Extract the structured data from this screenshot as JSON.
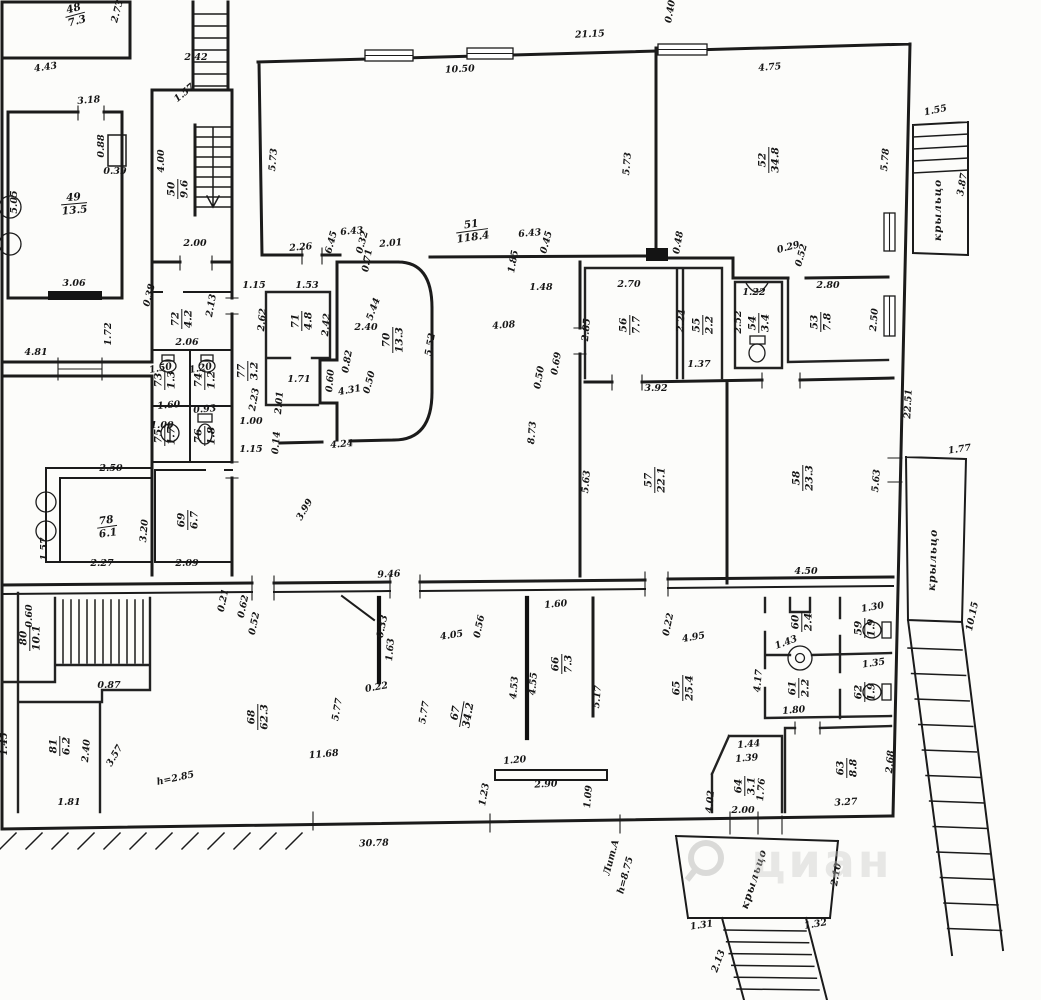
{
  "document": {
    "type": "architectural-floor-plan",
    "language": "ru",
    "watermark": "циан",
    "colors": {
      "paper": "#fcfcfa",
      "ink": "#1b1b1b",
      "watermark": "#c6c6c4"
    }
  },
  "rooms": [
    {
      "num": "48",
      "area": "7.3",
      "x": 75,
      "y": 14,
      "r": -15
    },
    {
      "num": "49",
      "area": "13.5",
      "x": 74,
      "y": 203,
      "r": -5
    },
    {
      "num": "50",
      "area": "9.6",
      "x": 177,
      "y": 189,
      "r": -90
    },
    {
      "num": "51",
      "area": "118.4",
      "x": 472,
      "y": 230,
      "r": -8
    },
    {
      "num": "52",
      "area": "34.8",
      "x": 768,
      "y": 160,
      "r": -90
    },
    {
      "num": "53",
      "area": "7.8",
      "x": 820,
      "y": 322,
      "r": -90
    },
    {
      "num": "54",
      "area": "3.4",
      "x": 758,
      "y": 323,
      "r": -90
    },
    {
      "num": "55",
      "area": "2.2",
      "x": 702,
      "y": 325,
      "r": -90
    },
    {
      "num": "56",
      "area": "7.7",
      "x": 629,
      "y": 325,
      "r": -90
    },
    {
      "num": "57",
      "area": "22.1",
      "x": 654,
      "y": 480,
      "r": -90
    },
    {
      "num": "58",
      "area": "23.3",
      "x": 802,
      "y": 478,
      "r": -90
    },
    {
      "num": "59",
      "area": "1.9",
      "x": 864,
      "y": 628,
      "r": -90
    },
    {
      "num": "60",
      "area": "2.4",
      "x": 801,
      "y": 622,
      "r": -90
    },
    {
      "num": "61",
      "area": "2.2",
      "x": 798,
      "y": 688,
      "r": -90
    },
    {
      "num": "62",
      "area": "1.9",
      "x": 864,
      "y": 692,
      "r": -90
    },
    {
      "num": "63",
      "area": "8.8",
      "x": 846,
      "y": 768,
      "r": -90
    },
    {
      "num": "64",
      "area": "3.1",
      "x": 744,
      "y": 786,
      "r": -90
    },
    {
      "num": "65",
      "area": "25.4",
      "x": 682,
      "y": 688,
      "r": -90
    },
    {
      "num": "66",
      "area": "7.3",
      "x": 561,
      "y": 664,
      "r": -90
    },
    {
      "num": "67",
      "area": "34.2",
      "x": 461,
      "y": 714,
      "r": -80
    },
    {
      "num": "68",
      "area": "62.3",
      "x": 257,
      "y": 717,
      "r": -90
    },
    {
      "num": "69",
      "area": "6.7",
      "x": 187,
      "y": 520,
      "r": -90
    },
    {
      "num": "70",
      "area": "13.3",
      "x": 392,
      "y": 340,
      "r": -90
    },
    {
      "num": "71",
      "area": "4.8",
      "x": 301,
      "y": 321,
      "r": -90
    },
    {
      "num": "72",
      "area": "4.2",
      "x": 181,
      "y": 319,
      "r": -90
    },
    {
      "num": "73",
      "area": "1.3",
      "x": 164,
      "y": 380,
      "r": -90
    },
    {
      "num": "74",
      "area": "1.2",
      "x": 204,
      "y": 380,
      "r": -90
    },
    {
      "num": "75",
      "area": "1.7",
      "x": 164,
      "y": 436,
      "r": -90
    },
    {
      "num": "76",
      "area": "1.8",
      "x": 204,
      "y": 436,
      "r": -90
    },
    {
      "num": "77",
      "area": "3.2",
      "x": 247,
      "y": 371,
      "r": -90
    },
    {
      "num": "78",
      "area": "6.1",
      "x": 107,
      "y": 526,
      "r": -8
    },
    {
      "num": "80",
      "area": "10.1",
      "x": 29,
      "y": 638,
      "r": -90
    },
    {
      "num": "81",
      "area": "6.2",
      "x": 59,
      "y": 746,
      "r": -90
    }
  ],
  "dims": [
    {
      "t": "2.73",
      "x": 120,
      "y": 12,
      "r": -75
    },
    {
      "t": "2.42",
      "x": 196,
      "y": 60,
      "r": 0
    },
    {
      "t": "4.43",
      "x": 46,
      "y": 70,
      "r": -8
    },
    {
      "t": "1.57",
      "x": 186,
      "y": 95,
      "r": -40
    },
    {
      "t": "3.18",
      "x": 89,
      "y": 103,
      "r": -5
    },
    {
      "t": "0.88",
      "x": 104,
      "y": 146,
      "r": -90
    },
    {
      "t": "0.39",
      "x": 115,
      "y": 174,
      "r": 0
    },
    {
      "t": "5.05",
      "x": 17,
      "y": 202,
      "r": -90
    },
    {
      "t": "4.00",
      "x": 164,
      "y": 161,
      "r": -90
    },
    {
      "t": "2.00",
      "x": 195,
      "y": 246,
      "r": 0
    },
    {
      "t": "3.06",
      "x": 74,
      "y": 286,
      "r": 0
    },
    {
      "t": "21.15",
      "x": 590,
      "y": 37,
      "r": -3
    },
    {
      "t": "10.50",
      "x": 460,
      "y": 72,
      "r": -3
    },
    {
      "t": "5.73",
      "x": 276,
      "y": 160,
      "r": -85
    },
    {
      "t": "5.73",
      "x": 630,
      "y": 164,
      "r": -85
    },
    {
      "t": "2.26",
      "x": 301,
      "y": 250,
      "r": -5
    },
    {
      "t": "6.45",
      "x": 334,
      "y": 243,
      "r": -75
    },
    {
      "t": "6.43",
      "x": 352,
      "y": 234,
      "r": -5
    },
    {
      "t": "0.32",
      "x": 365,
      "y": 243,
      "r": -75
    },
    {
      "t": "0.71",
      "x": 370,
      "y": 261,
      "r": -80
    },
    {
      "t": "2.01",
      "x": 391,
      "y": 246,
      "r": -5
    },
    {
      "t": "6.43",
      "x": 530,
      "y": 236,
      "r": -5
    },
    {
      "t": "0.45",
      "x": 549,
      "y": 243,
      "r": -75
    },
    {
      "t": "1.85",
      "x": 516,
      "y": 262,
      "r": -80
    },
    {
      "t": "1.48",
      "x": 541,
      "y": 290,
      "r": 0
    },
    {
      "t": "4.75",
      "x": 770,
      "y": 70,
      "r": -5
    },
    {
      "t": "5.78",
      "x": 888,
      "y": 160,
      "r": -85
    },
    {
      "t": "0.40",
      "x": 673,
      "y": 12,
      "r": -80
    },
    {
      "t": "0.48",
      "x": 681,
      "y": 243,
      "r": -80
    },
    {
      "t": "0.29",
      "x": 789,
      "y": 250,
      "r": -15
    },
    {
      "t": "0.52",
      "x": 804,
      "y": 256,
      "r": -75
    },
    {
      "t": "1.22",
      "x": 754,
      "y": 295,
      "r": 0
    },
    {
      "t": "2.52",
      "x": 741,
      "y": 322,
      "r": -90
    },
    {
      "t": "2.80",
      "x": 828,
      "y": 288,
      "r": 0
    },
    {
      "t": "2.50",
      "x": 877,
      "y": 320,
      "r": -85
    },
    {
      "t": "2.70",
      "x": 629,
      "y": 287,
      "r": 0
    },
    {
      "t": "2.85",
      "x": 589,
      "y": 330,
      "r": -85
    },
    {
      "t": "2.24",
      "x": 684,
      "y": 321,
      "r": -85
    },
    {
      "t": "1.37",
      "x": 699,
      "y": 367,
      "r": 0
    },
    {
      "t": "3.92",
      "x": 656,
      "y": 391,
      "r": 0
    },
    {
      "t": "4.08",
      "x": 504,
      "y": 328,
      "r": -5
    },
    {
      "t": "0.69",
      "x": 559,
      "y": 364,
      "r": -80
    },
    {
      "t": "0.50",
      "x": 542,
      "y": 378,
      "r": -80
    },
    {
      "t": "8.73",
      "x": 535,
      "y": 433,
      "r": -85
    },
    {
      "t": "5.63",
      "x": 589,
      "y": 482,
      "r": -85
    },
    {
      "t": "5.63",
      "x": 879,
      "y": 481,
      "r": -85
    },
    {
      "t": "4.50",
      "x": 806,
      "y": 574,
      "r": 0
    },
    {
      "t": "22.51",
      "x": 911,
      "y": 404,
      "r": -87
    },
    {
      "t": "1.77",
      "x": 960,
      "y": 452,
      "r": -8
    },
    {
      "t": "10.15",
      "x": 975,
      "y": 617,
      "r": -78
    },
    {
      "t": "1.55",
      "x": 936,
      "y": 113,
      "r": -12
    },
    {
      "t": "3.87",
      "x": 965,
      "y": 185,
      "r": -80
    },
    {
      "t": "4.81",
      "x": 36,
      "y": 355,
      "r": 0
    },
    {
      "t": "1.72",
      "x": 111,
      "y": 334,
      "r": -90
    },
    {
      "t": "0.38",
      "x": 152,
      "y": 296,
      "r": -75
    },
    {
      "t": "2.13",
      "x": 214,
      "y": 306,
      "r": -80
    },
    {
      "t": "2.06",
      "x": 187,
      "y": 345,
      "r": 0
    },
    {
      "t": "1.15",
      "x": 254,
      "y": 288,
      "r": 0
    },
    {
      "t": "1.53",
      "x": 307,
      "y": 288,
      "r": 0
    },
    {
      "t": "2.62",
      "x": 265,
      "y": 320,
      "r": -85
    },
    {
      "t": "2.42",
      "x": 329,
      "y": 325,
      "r": -85
    },
    {
      "t": "5.44",
      "x": 376,
      "y": 310,
      "r": -70
    },
    {
      "t": "2.40",
      "x": 366,
      "y": 330,
      "r": 0
    },
    {
      "t": "5.52",
      "x": 433,
      "y": 345,
      "r": -80
    },
    {
      "t": "0.82",
      "x": 350,
      "y": 362,
      "r": -80
    },
    {
      "t": "0.60",
      "x": 333,
      "y": 381,
      "r": -85
    },
    {
      "t": "0.50",
      "x": 372,
      "y": 383,
      "r": -75
    },
    {
      "t": "4.31",
      "x": 350,
      "y": 393,
      "r": -10
    },
    {
      "t": "1.71",
      "x": 299,
      "y": 382,
      "r": 0
    },
    {
      "t": "2.23",
      "x": 257,
      "y": 400,
      "r": -80
    },
    {
      "t": "2.01",
      "x": 282,
      "y": 403,
      "r": -85
    },
    {
      "t": "1.00",
      "x": 251,
      "y": 424,
      "r": 0
    },
    {
      "t": "1.15",
      "x": 251,
      "y": 452,
      "r": 0
    },
    {
      "t": "0.14",
      "x": 279,
      "y": 443,
      "r": -85
    },
    {
      "t": "4.24",
      "x": 342,
      "y": 447,
      "r": -5
    },
    {
      "t": "3.99",
      "x": 307,
      "y": 511,
      "r": -60
    },
    {
      "t": "9.46",
      "x": 389,
      "y": 577,
      "r": -3
    },
    {
      "t": "1.50",
      "x": 161,
      "y": 371,
      "r": -10
    },
    {
      "t": "1.20",
      "x": 201,
      "y": 371,
      "r": -10
    },
    {
      "t": "1.60",
      "x": 169,
      "y": 408,
      "r": -5
    },
    {
      "t": "0.93",
      "x": 205,
      "y": 412,
      "r": -5
    },
    {
      "t": "1.00",
      "x": 162,
      "y": 428,
      "r": 0
    },
    {
      "t": "2.50",
      "x": 111,
      "y": 471,
      "r": 0
    },
    {
      "t": "1.57",
      "x": 47,
      "y": 549,
      "r": -90
    },
    {
      "t": "2.27",
      "x": 102,
      "y": 566,
      "r": 0
    },
    {
      "t": "3.20",
      "x": 147,
      "y": 531,
      "r": -85
    },
    {
      "t": "2.09",
      "x": 187,
      "y": 566,
      "r": 0
    },
    {
      "t": "0.21",
      "x": 226,
      "y": 601,
      "r": -78
    },
    {
      "t": "0.62",
      "x": 246,
      "y": 607,
      "r": -78
    },
    {
      "t": "0.52",
      "x": 257,
      "y": 624,
      "r": -78
    },
    {
      "t": "0.60",
      "x": 32,
      "y": 616,
      "r": -90
    },
    {
      "t": "0.87",
      "x": 109,
      "y": 688,
      "r": 0
    },
    {
      "t": "2.40",
      "x": 89,
      "y": 751,
      "r": -85
    },
    {
      "t": "3.57",
      "x": 117,
      "y": 757,
      "r": -60
    },
    {
      "t": "1.81",
      "x": 69,
      "y": 805,
      "r": 0
    },
    {
      "t": "1.45",
      "x": 7,
      "y": 744,
      "r": -90
    },
    {
      "t": "11.68",
      "x": 324,
      "y": 757,
      "r": -5
    },
    {
      "t": "5.77",
      "x": 340,
      "y": 710,
      "r": -80
    },
    {
      "t": "5.77",
      "x": 427,
      "y": 713,
      "r": -80
    },
    {
      "t": "0.22",
      "x": 377,
      "y": 690,
      "r": -10
    },
    {
      "t": "0.33",
      "x": 385,
      "y": 627,
      "r": -78
    },
    {
      "t": "1.63",
      "x": 393,
      "y": 650,
      "r": -85
    },
    {
      "t": "4.05",
      "x": 452,
      "y": 638,
      "r": -8
    },
    {
      "t": "0.56",
      "x": 482,
      "y": 627,
      "r": -78
    },
    {
      "t": "1.60",
      "x": 556,
      "y": 607,
      "r": -5
    },
    {
      "t": "0.22",
      "x": 671,
      "y": 625,
      "r": -78
    },
    {
      "t": "4.95",
      "x": 694,
      "y": 640,
      "r": -10
    },
    {
      "t": "4.53",
      "x": 517,
      "y": 688,
      "r": -85
    },
    {
      "t": "4.55",
      "x": 536,
      "y": 684,
      "r": -85
    },
    {
      "t": "5.17",
      "x": 600,
      "y": 697,
      "r": -85
    },
    {
      "t": "1.20",
      "x": 515,
      "y": 763,
      "r": -5
    },
    {
      "t": "2.90",
      "x": 546,
      "y": 787,
      "r": -3
    },
    {
      "t": "1.23",
      "x": 487,
      "y": 795,
      "r": -80
    },
    {
      "t": "1.09",
      "x": 591,
      "y": 797,
      "r": -85
    },
    {
      "t": "30.78",
      "x": 374,
      "y": 846,
      "r": -2
    },
    {
      "t": "1.30",
      "x": 873,
      "y": 610,
      "r": -10
    },
    {
      "t": "1.35",
      "x": 874,
      "y": 666,
      "r": -8
    },
    {
      "t": "1.43",
      "x": 787,
      "y": 645,
      "r": -20
    },
    {
      "t": "1.80",
      "x": 794,
      "y": 713,
      "r": -5
    },
    {
      "t": "4.17",
      "x": 761,
      "y": 681,
      "r": -85
    },
    {
      "t": "1.44",
      "x": 749,
      "y": 747,
      "r": -5
    },
    {
      "t": "1.39",
      "x": 747,
      "y": 761,
      "r": -5
    },
    {
      "t": "1.76",
      "x": 764,
      "y": 790,
      "r": -85
    },
    {
      "t": "2.00",
      "x": 743,
      "y": 813,
      "r": 0
    },
    {
      "t": "4.02",
      "x": 713,
      "y": 802,
      "r": -85
    },
    {
      "t": "3.27",
      "x": 846,
      "y": 805,
      "r": -3
    },
    {
      "t": "2.68",
      "x": 893,
      "y": 762,
      "r": -85
    },
    {
      "t": "1.31",
      "x": 702,
      "y": 928,
      "r": -8
    },
    {
      "t": "1.32",
      "x": 816,
      "y": 927,
      "r": -10
    },
    {
      "t": "2.10",
      "x": 839,
      "y": 875,
      "r": -80
    },
    {
      "t": "2.13",
      "x": 721,
      "y": 962,
      "r": -70
    }
  ],
  "porches": [
    {
      "t": "крыльцо",
      "x": 941,
      "y": 210,
      "r": -90
    },
    {
      "t": "крыльцо",
      "x": 936,
      "y": 560,
      "r": -88
    },
    {
      "t": "крыльцо",
      "x": 757,
      "y": 880,
      "r": -72
    }
  ],
  "notes": [
    {
      "t": "h=2.85",
      "x": 176,
      "y": 781,
      "r": -12
    },
    {
      "t": "Лит.А",
      "x": 614,
      "y": 858,
      "r": -75
    },
    {
      "t": "h=8.75",
      "x": 628,
      "y": 876,
      "r": -75
    }
  ]
}
